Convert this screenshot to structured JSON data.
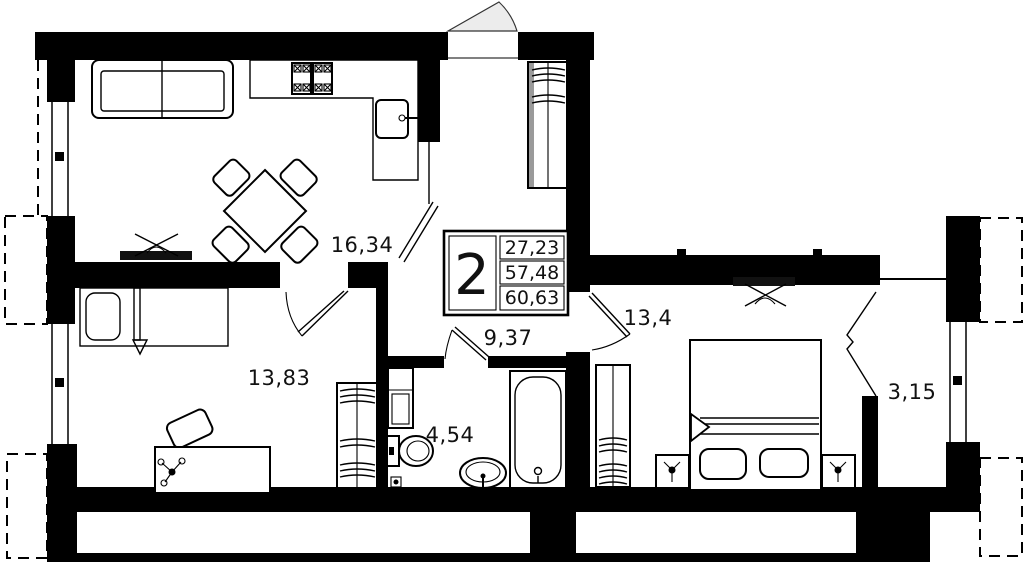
{
  "plan": {
    "type": "apartment-floor-plan",
    "badge": {
      "rooms_count": "2",
      "areas": [
        "27,23",
        "57,48",
        "60,63"
      ]
    },
    "room_labels": {
      "living_kitchen": "16,34",
      "bedroom_second": "13,83",
      "hallway": "9,37",
      "bathroom": "4,54",
      "bedroom_master": "13,4",
      "balcony": "3,15"
    },
    "colors": {
      "wall": "#000000",
      "background": "#ffffff",
      "door_swing": "#ececec",
      "tv": "#111111"
    }
  }
}
